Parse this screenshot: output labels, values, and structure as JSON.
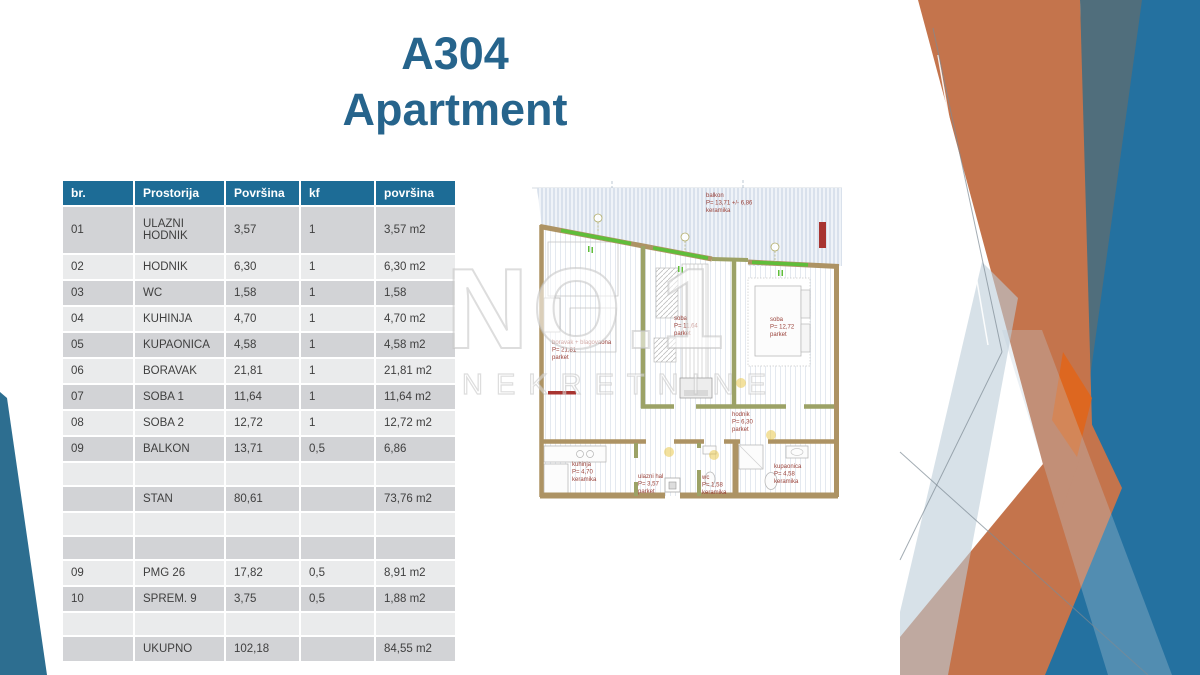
{
  "slide": {
    "title_line1": "A304",
    "title_line2": "Apartment"
  },
  "table": {
    "headers": [
      "br.",
      "Prostorija",
      "Površina",
      "kf",
      "površina"
    ],
    "rows": [
      {
        "cells": [
          "01",
          "ULAZNI HODNIK",
          "3,57",
          "1",
          "3,57 m2"
        ],
        "tall": true
      },
      {
        "cells": [
          "02",
          "HODNIK",
          "6,30",
          "1",
          "6,30 m2"
        ]
      },
      {
        "cells": [
          "03",
          "WC",
          "1,58",
          "1",
          "1,58"
        ]
      },
      {
        "cells": [
          "04",
          "KUHINJA",
          "4,70",
          "1",
          "4,70 m2"
        ]
      },
      {
        "cells": [
          "05",
          "KUPAONICA",
          "4,58",
          "1",
          "4,58 m2"
        ]
      },
      {
        "cells": [
          "06",
          "BORAVAK",
          "21,81",
          "1",
          "21,81 m2"
        ]
      },
      {
        "cells": [
          "07",
          "SOBA 1",
          "11,64",
          "1",
          "11,64 m2"
        ]
      },
      {
        "cells": [
          "08",
          "SOBA 2",
          "12,72",
          "1",
          "12,72 m2"
        ]
      },
      {
        "cells": [
          "09",
          "BALKON",
          "13,71",
          "0,5",
          "6,86"
        ]
      },
      {
        "cells": [
          "",
          "",
          "",
          "",
          ""
        ]
      },
      {
        "cells": [
          "",
          "STAN",
          "80,61",
          "",
          "73,76 m2"
        ]
      },
      {
        "cells": [
          "",
          "",
          "",
          "",
          ""
        ]
      },
      {
        "cells": [
          "",
          "",
          "",
          "",
          ""
        ]
      },
      {
        "cells": [
          "09",
          "PMG 26",
          "17,82",
          "0,5",
          "8,91 m2"
        ]
      },
      {
        "cells": [
          "10",
          "SPREM. 9",
          "3,75",
          "0,5",
          "1,88 m2"
        ]
      },
      {
        "cells": [
          "",
          "",
          "",
          "",
          ""
        ]
      },
      {
        "cells": [
          "",
          "UKUPNO",
          "102,18",
          "",
          "84,55 m2"
        ]
      }
    ]
  },
  "floorplan": {
    "labels": [
      {
        "name": "balkon",
        "area": "P= 13,71 +/- 6,86",
        "floor": "keramika"
      },
      {
        "name": "boravak + blagovaona",
        "area": "P= 21,81",
        "floor": "parket"
      },
      {
        "name": "soba",
        "area": "P= 11,64",
        "floor": "parket"
      },
      {
        "name": "soba",
        "area": "P= 12,72",
        "floor": "parket"
      },
      {
        "name": "hodnik",
        "area": "P= 6,30",
        "floor": "parket"
      },
      {
        "name": "kuhinja",
        "area": "P= 4,70",
        "floor": "keramika"
      },
      {
        "name": "ulazni hal",
        "area": "P= 3,57",
        "floor": "parket"
      },
      {
        "name": "wc",
        "area": "P= 1,58",
        "floor": "keramika"
      },
      {
        "name": "kupaonica",
        "area": "P= 4,58",
        "floor": "keramika"
      }
    ]
  },
  "watermark": {
    "line1": "NO.1",
    "line2": "NEKRETNINE"
  },
  "colors": {
    "accent_title": "#26648C",
    "table_header_bg": "#1D6C96",
    "table_row_dark": "#D2D3D6",
    "table_row_light": "#EAEBEC",
    "table_text": "#3F3F3F",
    "deco_blue": "#2471A0",
    "deco_slate": "#506E7C",
    "deco_orange": "#C4744C",
    "deco_orange_bright": "#E0661C",
    "deco_lightblue": "#BCCDD9",
    "deco_left_blue": "#2D6E90",
    "plan_wall_tan": "#AD9364",
    "plan_wall_olive": "#9CA266",
    "plan_window_green": "#5FBE3A",
    "plan_label_red": "#9A423A",
    "plan_hatch_blue": "#C7D3E2",
    "watermark_gray": "#D9D9D9"
  }
}
